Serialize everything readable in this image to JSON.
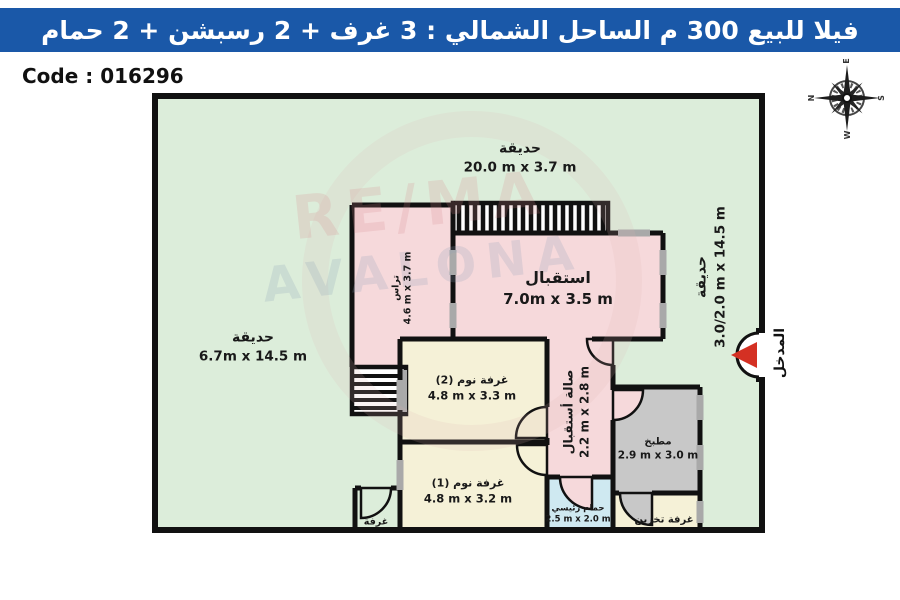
{
  "banner": {
    "title": "فيلا للبيع 300 م الساحل الشمالي  :  3 غرف + 2 رسبشن + 2 حمام",
    "bg_color": "#1a58a8"
  },
  "code_label": "Code : 016296",
  "compass": {
    "e": "E",
    "s": "S",
    "w": "W",
    "n": "N"
  },
  "watermark": {
    "line1": "RE/MA",
    "line2": "AVALONA"
  },
  "colors": {
    "garden": "#dcedda",
    "room_pink": "#f6d9db",
    "room_cream": "#f5f1d7",
    "room_gray": "#c8c8c8",
    "room_blue": "#cfe9f1",
    "wall": "#111111",
    "window": "#a9a9a9",
    "entrance_arrow": "#d43023"
  },
  "gardens": {
    "top": {
      "name": "حديقة",
      "dims": "20.0 m x 3.7 m"
    },
    "left": {
      "name": "حديقة",
      "dims": "6.7m x 14.5 m"
    },
    "right": {
      "name": "حديقة",
      "dims": "3.0/2.0 m x 14.5 m"
    }
  },
  "rooms": {
    "terrace": {
      "name": "تراس",
      "dims": "4.6 m x 3.7 m"
    },
    "reception": {
      "name": "استقبال",
      "dims": "7.0m x 3.5 m"
    },
    "hall": {
      "name": "صالة أستقبال",
      "dims": "2.2 m x 2.8 m"
    },
    "bedroom2": {
      "name": "غرفة نوم (2)",
      "dims": "4.8 m x 3.3 m"
    },
    "bedroom1": {
      "name": "غرفة نوم (1)",
      "dims": "4.8 m x 3.2 m"
    },
    "kitchen": {
      "name": "مطبخ",
      "dims": "2.9 m x 3.0 m"
    },
    "bathroom": {
      "name": "حمام رئيسي",
      "dims": "2.5 m x 2.0 m"
    },
    "storage": {
      "name": "غرفة تخزين"
    },
    "small_room": {
      "name": "غرفة"
    }
  },
  "entrance_label": "المدخل"
}
